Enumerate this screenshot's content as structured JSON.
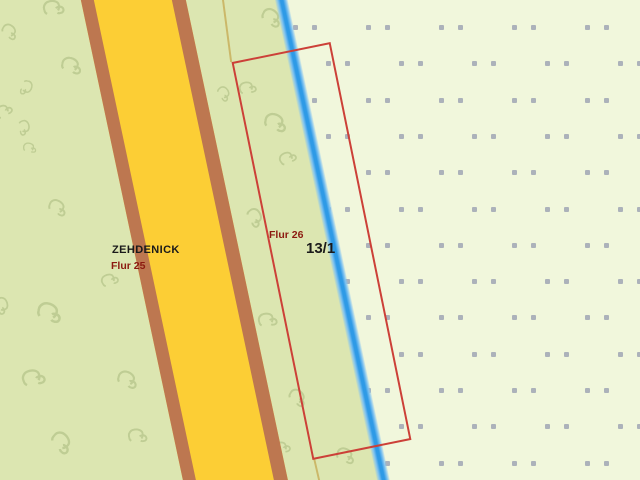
{
  "map": {
    "labels": {
      "district": "ZEHDENICK",
      "flur_left": "Flur 25",
      "flur_right": "Flur 26",
      "parcel_number": "13/1"
    },
    "colors": {
      "green": "#dce6b1",
      "cream": "#f1f7dc",
      "road_fill": "#fcce35",
      "road_edge": "#bd7750",
      "water_blue": "#2e9ae6",
      "selection_red": "#cc4038",
      "boundary_tan": "#c9b362",
      "dot_gray": "#a0a6b4",
      "symbol_green": "#b9c88e",
      "label_dark_red": "#8c1a10",
      "label_black": "#1a1a1a"
    },
    "vegetation_symbols": [
      {
        "x": 44,
        "y": 0,
        "s": 1.1,
        "r": -15
      },
      {
        "x": 0,
        "y": 24,
        "s": 0.9,
        "r": 30
      },
      {
        "x": 62,
        "y": 58,
        "s": 1.1,
        "r": 10
      },
      {
        "x": 140,
        "y": 35,
        "s": 0.8,
        "r": -60
      },
      {
        "x": 16,
        "y": 80,
        "s": 0.8,
        "r": 100
      },
      {
        "x": -6,
        "y": 103,
        "s": 0.9,
        "r": -40
      },
      {
        "x": 14,
        "y": 120,
        "s": 0.8,
        "r": 70
      },
      {
        "x": 20,
        "y": 140,
        "s": 0.7,
        "r": 0
      },
      {
        "x": 48,
        "y": 200,
        "s": 1.0,
        "r": 20
      },
      {
        "x": 100,
        "y": 272,
        "s": 0.9,
        "r": -30
      },
      {
        "x": 40,
        "y": 305,
        "s": 1.3,
        "r": 10
      },
      {
        "x": -8,
        "y": 298,
        "s": 0.9,
        "r": 60
      },
      {
        "x": 24,
        "y": 370,
        "s": 1.2,
        "r": -20
      },
      {
        "x": 118,
        "y": 372,
        "s": 1.1,
        "r": 15
      },
      {
        "x": 52,
        "y": 435,
        "s": 1.2,
        "r": 40
      },
      {
        "x": 128,
        "y": 428,
        "s": 1.0,
        "r": -10
      },
      {
        "x": 262,
        "y": 10,
        "s": 1.1,
        "r": 25
      },
      {
        "x": 238,
        "y": 80,
        "s": 0.9,
        "r": -20
      },
      {
        "x": 214,
        "y": 86,
        "s": 0.8,
        "r": 45
      },
      {
        "x": 266,
        "y": 115,
        "s": 1.2,
        "r": 10
      },
      {
        "x": 278,
        "y": 150,
        "s": 0.9,
        "r": -35
      },
      {
        "x": 245,
        "y": 210,
        "s": 1.0,
        "r": 50
      },
      {
        "x": 258,
        "y": 312,
        "s": 1.0,
        "r": -15
      },
      {
        "x": 288,
        "y": 390,
        "s": 1.0,
        "r": 30
      },
      {
        "x": 272,
        "y": 440,
        "s": 0.9,
        "r": -25
      },
      {
        "x": 336,
        "y": 448,
        "s": 1.0,
        "r": 15
      }
    ],
    "dot_pattern": {
      "rows": 13,
      "start_y": 25,
      "row_step": 36.3,
      "col_step": 73,
      "pair_gap": 19,
      "even_base_x": 366,
      "odd_base_x": 326,
      "min_x": 288,
      "max_x": 634
    }
  }
}
